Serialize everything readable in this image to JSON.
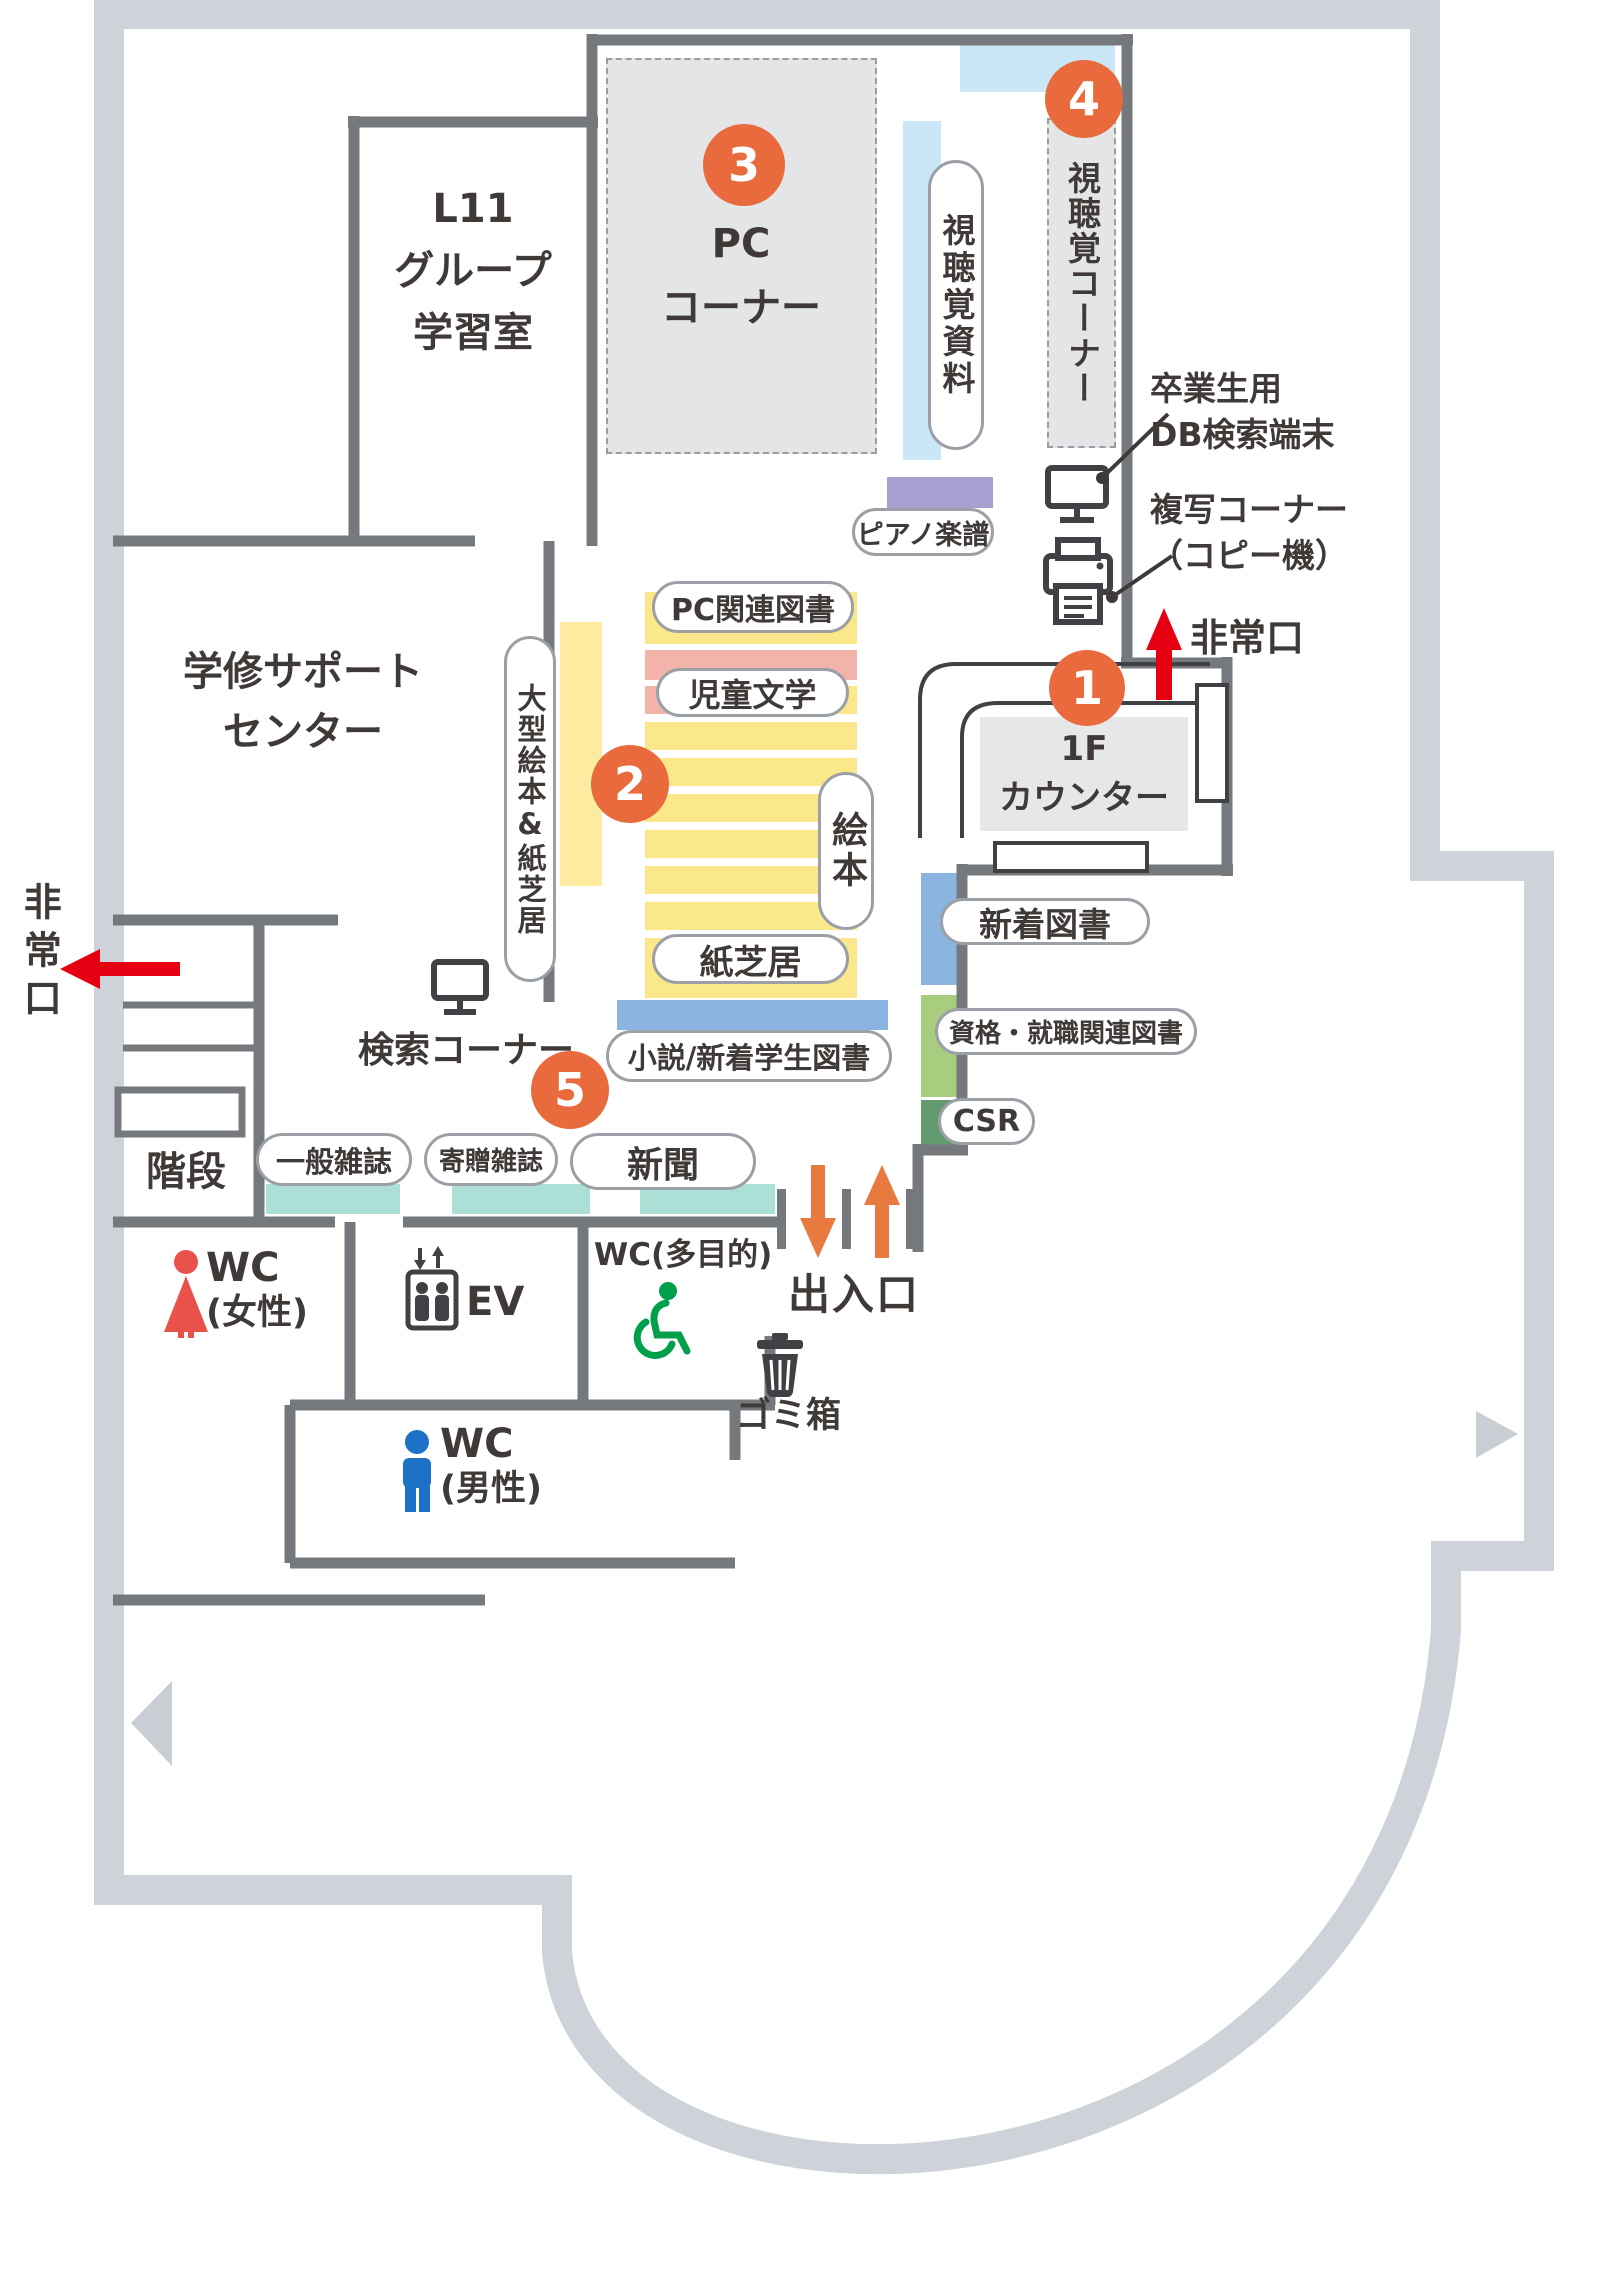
{
  "palette": {
    "outer-wall": "#ced3d9",
    "inner-wall": "#75797e",
    "text": "#3f3a37",
    "marker-orange": "#e96a3d",
    "red": "#e60012",
    "entrance-orange": "#e8793f",
    "yellow": "#fbe88a",
    "pale-yellow": "#fdeca0",
    "pink": "#f1b3aa",
    "light-blue": "#c9e7f6",
    "purple": "#a79fd0",
    "blue": "#8bb4e0",
    "green": "#a8cd7e",
    "dark-green": "#639a70",
    "teal": "#ace0d6",
    "box-gray": "#e4e5e7",
    "counter-gray": "#e6e7e9",
    "pill-border": "#9aa0a6",
    "icon-dark": "#3f4144",
    "wc-red": "#e8524a",
    "wc-blue": "#1d71c7",
    "wc-green": "#00a04a",
    "triangle-gray": "#c9ced4"
  },
  "markers": {
    "counter": "1",
    "picture_books": "2",
    "pc": "3",
    "av": "4",
    "newspaper": "5"
  },
  "rooms": {
    "l11": [
      "L11",
      "グループ",
      "学習室"
    ],
    "support_center": [
      "学修サポート",
      "センター"
    ],
    "pc_corner": [
      "PC",
      "コーナー"
    ],
    "av_corner": "視聴覚コーナー",
    "stairs": "階段",
    "counter": [
      "1F",
      "カウンター"
    ]
  },
  "shelves": {
    "av_materials": "視聴覚資料",
    "piano_scores": "ピアノ楽譜",
    "pc_books": "PC関連図書",
    "children_lit": "児童文学",
    "picture_books": "絵本",
    "kamishibai": "紙芝居",
    "large_picture_books": "大型絵本&紙芝居",
    "novels_new_students": "小説/新着学生図書",
    "new_books": "新着図書",
    "career_books": "資格・就職関連図書",
    "csr": "CSR",
    "magazines": "一般雑誌",
    "donated_magazines": "寄贈雑誌",
    "newspapers": "新聞"
  },
  "annotations": {
    "db_terminal": [
      "卒業生用",
      "DB検索端末"
    ],
    "copy_corner": [
      "複写コーナー",
      "（コピー機）"
    ],
    "emergency_exit_top": "非常口",
    "emergency_exit_left": "非常口",
    "search_corner": "検索コーナー",
    "entrance": "出入口",
    "trash": "ゴミ箱"
  },
  "facilities": {
    "wc_female": [
      "WC",
      "(女性)"
    ],
    "wc_male": [
      "WC",
      "(男性)"
    ],
    "wc_multi": "WC(多目的)",
    "elevator": "EV"
  }
}
